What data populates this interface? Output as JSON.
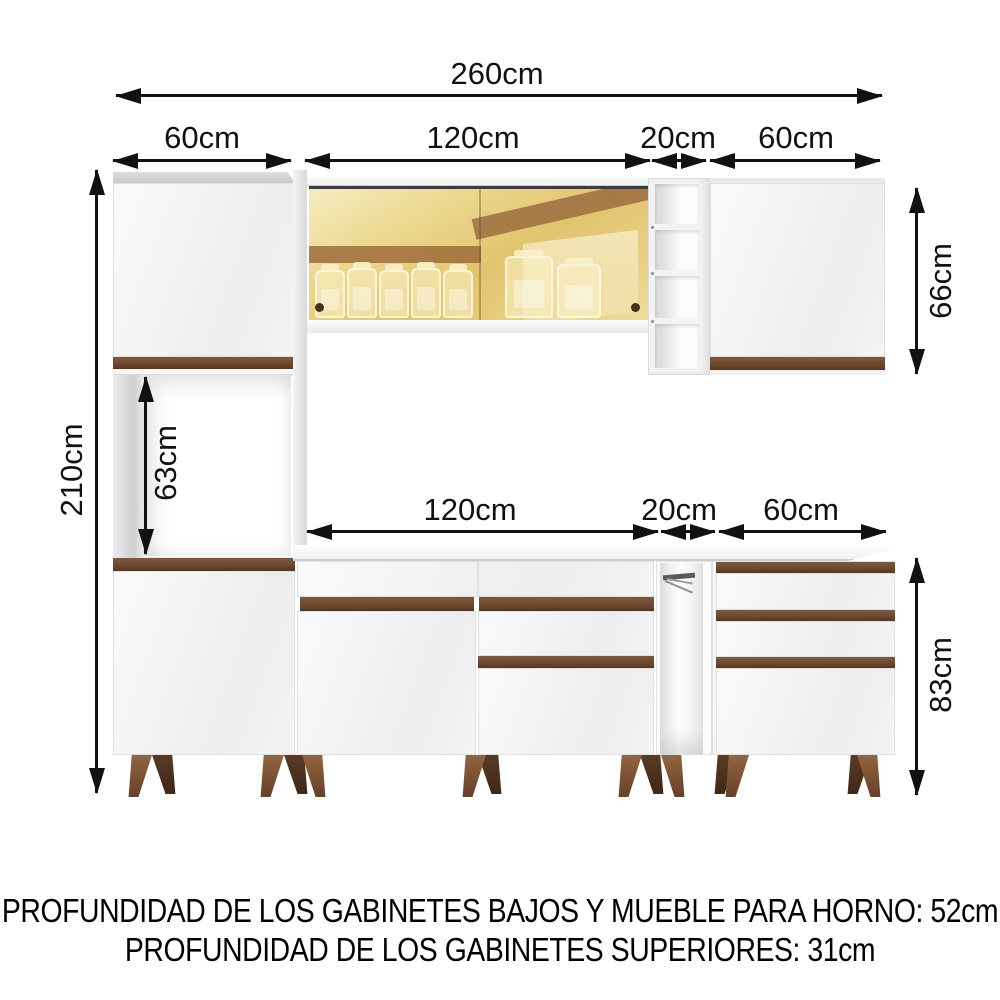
{
  "dimensions": {
    "total_width": "260cm",
    "total_height": "210cm",
    "upper_row": {
      "left_tower_width": "60cm",
      "glass_cabinet_width": "120cm",
      "open_shelf_width": "20cm",
      "right_cabinet_width": "60cm"
    },
    "lower_row": {
      "counter_width": "120cm",
      "open_tower_width": "20cm",
      "drawer_unit_width": "60cm"
    },
    "upper_cabinets_height": "66cm",
    "oven_space_height": "63cm",
    "base_cabinets_height": "83cm"
  },
  "footer": {
    "line1": "PROFUNDIDAD DE LOS GABINETES BAJOS Y MUEBLE PARA HORNO: 52cm",
    "line2": "PROFUNDIDAD DE LOS GABINETES SUPERIORES: 31cm"
  },
  "colors": {
    "arrow_and_text": "#111111",
    "wood_accent": "#6f4a32",
    "glass_amber": "#e4c877",
    "cabinet_white": "#f4f4f4"
  }
}
